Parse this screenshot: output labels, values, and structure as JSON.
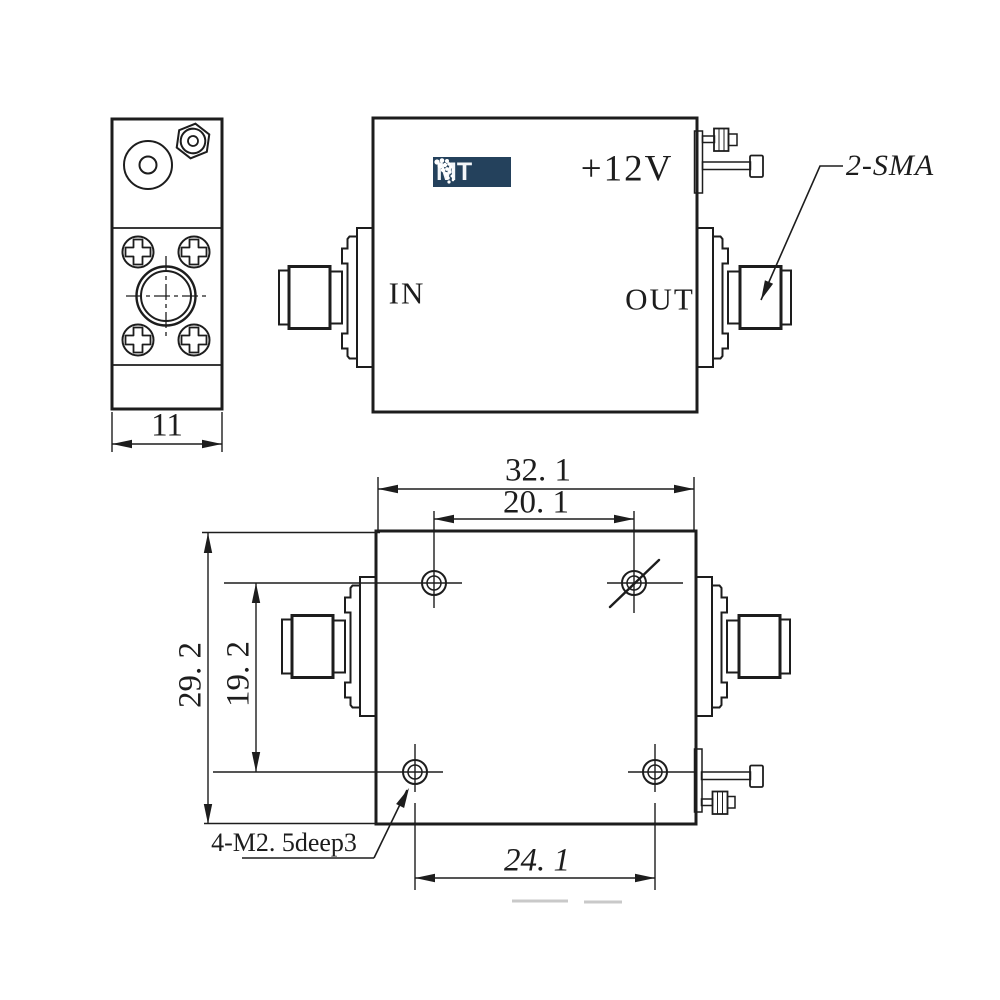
{
  "drawing": {
    "type": "technical-outline-drawing",
    "views": {
      "side": {
        "dim_width": "11"
      },
      "front": {
        "label_in": "IN",
        "label_out": "OUT",
        "label_voltage": "+12V",
        "callout_connectors": "2-SMA"
      },
      "bottom": {
        "dim_overall_width": "32. 1",
        "dim_hole_span_top": "20. 1",
        "dim_overall_height": "29. 2",
        "dim_hole_span_side": "19. 2",
        "dim_hole_span_bottom": "24. 1",
        "callout_threads": "4-M2. 5deep3"
      }
    },
    "logo": {
      "text": "MT",
      "mark_icon": "dot-fan",
      "bg_color": "#24415c",
      "text_color": "#f3f6f9"
    },
    "colors": {
      "line": "#1d1d1d",
      "background": "#ffffff"
    }
  }
}
